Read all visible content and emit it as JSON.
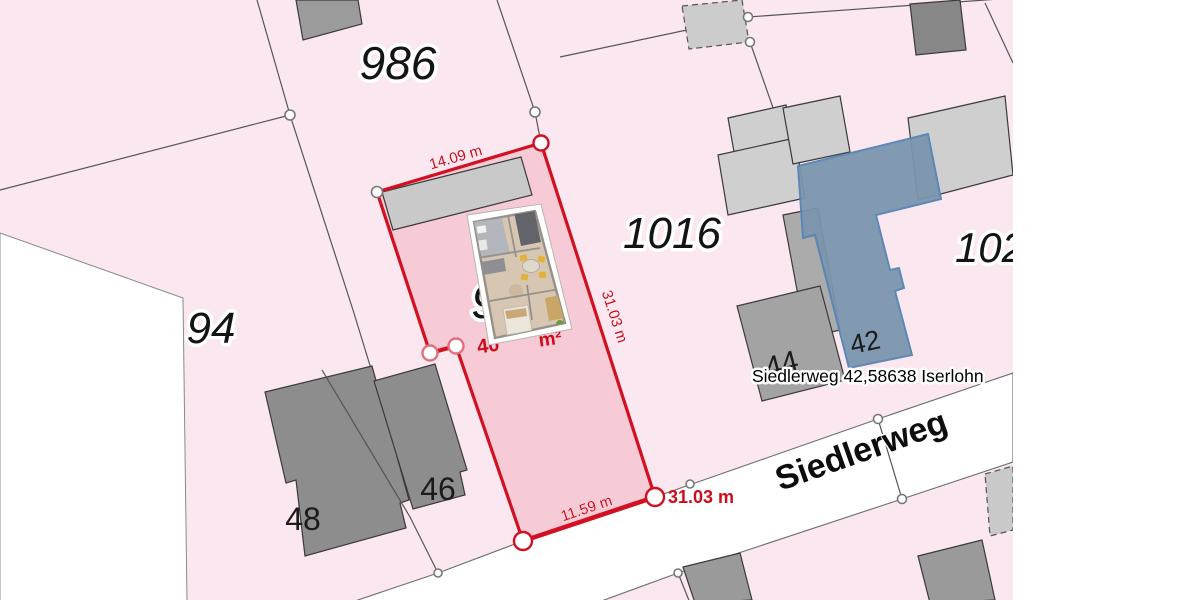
{
  "colors": {
    "canvas_white": "#ffffff",
    "map_pink": "#fbe7ef",
    "street_white": "#ffffff",
    "boundary_gray": "#5a5a5a",
    "building_light": "#cfcfcf",
    "building_mid": "#a6a6a6",
    "building_dark": "#8d8d8d",
    "highlight_red": "#d11021",
    "highlight_fill": "#f6c9d4",
    "selected_building_blue": "#7b95ae",
    "selected_building_blue_stroke": "#5585b4"
  },
  "labels": {
    "parcels": [
      {
        "text": "986"
      },
      {
        "text": "1016"
      },
      {
        "text": "94"
      },
      {
        "text": "93"
      },
      {
        "text": "102"
      }
    ],
    "house_numbers": [
      {
        "text": "48"
      },
      {
        "text": "46"
      },
      {
        "text": "44"
      },
      {
        "text": "42"
      }
    ],
    "street_name": "Siedlerweg",
    "address": "Siedlerweg 42,58638 Iserlohn"
  },
  "measurements": {
    "top_edge": "14.09 m",
    "right_edge": "31.03 m",
    "right_edge_bold": "31.03 m",
    "bottom_edge": "11.59 m",
    "area_prefix": "40",
    "area_unit": "m²"
  }
}
